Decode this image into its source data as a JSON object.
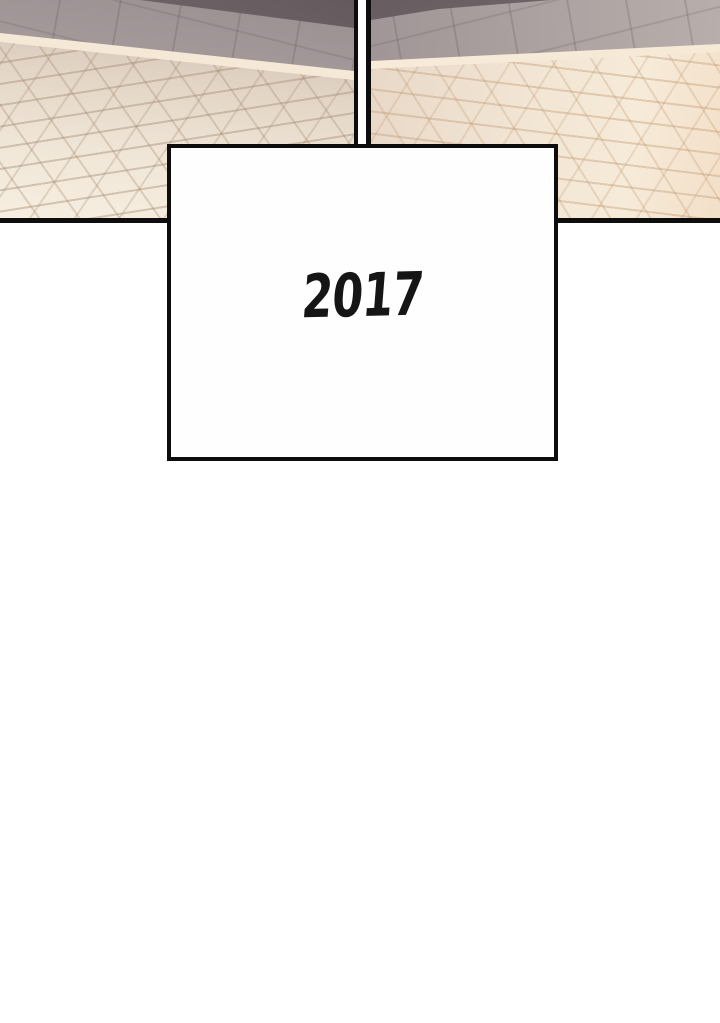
{
  "comic": {
    "caption": {
      "year": "2017"
    },
    "panels": [
      {
        "name": "street-pavement-left",
        "description": "cobblestone street panel with cream curb line and gray slab walkway"
      },
      {
        "name": "street-pavement-right",
        "description": "cobblestone street panel with cream curb line and gray slab walkway"
      }
    ],
    "colors": {
      "panel_border": "#0d0d0d",
      "slab_gray": "#aaa1a0",
      "wall_shadow": "#6f6467",
      "curb_cream": "#f5e6d3",
      "cobble_light": "#f2e7d7",
      "cobble_grout": "#b49f8b",
      "background": "#ffffff"
    }
  }
}
